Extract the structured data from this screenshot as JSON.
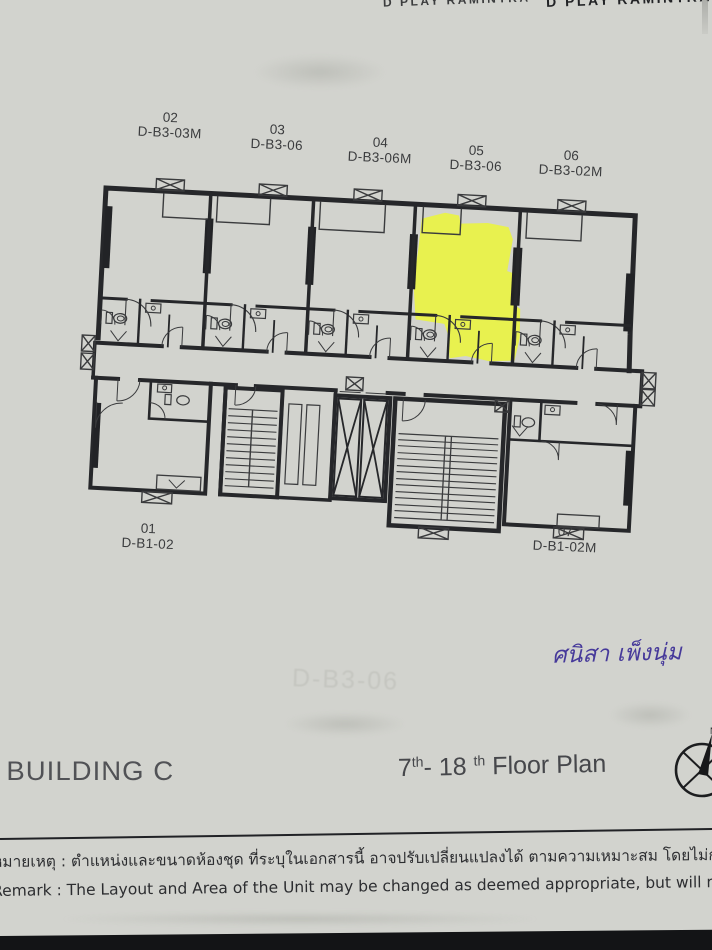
{
  "header": {
    "brand_left": "D PLAY RAMINTRA",
    "brand_right": "D PLAY RAMINTRA"
  },
  "plan": {
    "highlighted_unit": "05",
    "highlight_color": "#eaf53d",
    "top_units": [
      {
        "number": "02",
        "code": "D-B3-03M"
      },
      {
        "number": "03",
        "code": "D-B3-06"
      },
      {
        "number": "04",
        "code": "D-B3-06M"
      },
      {
        "number": "05",
        "code": "D-B3-06"
      },
      {
        "number": "06",
        "code": "D-B3-02M"
      }
    ],
    "bottom_units": [
      {
        "number": "01",
        "code": "D-B1-02"
      },
      {
        "number": "07",
        "code": "D-B1-02M"
      }
    ]
  },
  "ghost_text": {
    "unit_code": "D-B3-06"
  },
  "handwriting": {
    "text": "ศนิสา เพ็งนุ่ม",
    "color": "#46399a"
  },
  "footer": {
    "building": "BUILDING C",
    "floor_title": {
      "from": "7",
      "sup1": "th",
      "to": "- 18",
      "sup2": "th",
      "rest": " Floor Plan"
    },
    "compass_label": "N"
  },
  "remark": {
    "thai": "หมายเหตุ : ตำแหน่งและขนาดห้องชุด ที่ระบุในเอกสารนี้ อาจปรับเปลี่ยนแปลงได้ ตามความเหมาะสม โดยไม่กระทบต่อสาระสำคัญในการใช้งานและพักอาศัย",
    "english": "Remark : The Layout and Area of the Unit may be changed as deemed appropriate, but will not impact upon the use and dwelling"
  }
}
